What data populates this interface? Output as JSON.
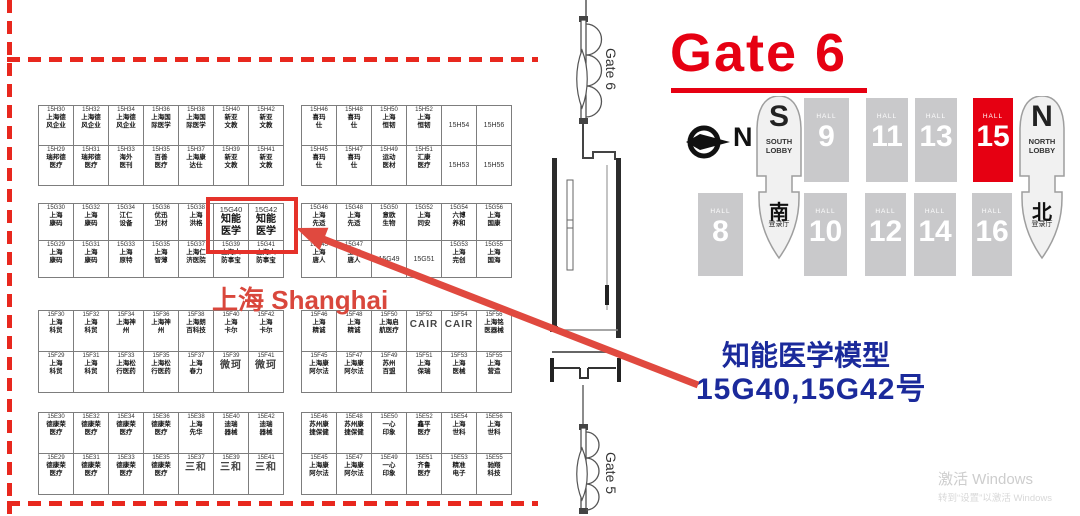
{
  "heading": {
    "gate6": "Gate 6"
  },
  "corridor": {
    "gate6_label": "Gate 6",
    "gate5_label": "Gate 5"
  },
  "compass": {
    "n": "N"
  },
  "hall_map": {
    "hall_label": "HALL",
    "halls_top": [
      {
        "num": "9"
      },
      {
        "num": "11"
      },
      {
        "num": "13"
      },
      {
        "num": "15",
        "highlight": true
      }
    ],
    "halls_bottom": [
      {
        "num": "8"
      },
      {
        "num": "10"
      },
      {
        "num": "12"
      },
      {
        "num": "14"
      },
      {
        "num": "16"
      }
    ],
    "south_lobby": {
      "letter": "S",
      "line1": "SOUTH",
      "line2": "LOBBY"
    },
    "north_lobby": {
      "letter": "N",
      "line1": "NORTH",
      "line2": "LOBBY"
    },
    "south_reg": {
      "cn": "南",
      "sub": "登录厅"
    },
    "north_reg": {
      "cn": "北",
      "sub": "登录厅"
    }
  },
  "annotation": {
    "line1": "知能医学模型",
    "line2": "15G40,15G42号",
    "shanghai": "上海 Shanghai"
  },
  "watermark": {
    "line1": "激活 Windows",
    "line2": "转到“设置”以激活 Windows"
  },
  "colors": {
    "accent_red": "#e60012",
    "arrow_red": "#e0493f",
    "annotation_blue": "#1b2a9b",
    "hall_gray": "#c9c9cb"
  },
  "booth_blocks": {
    "h_left": [
      [
        [
          "15H30",
          "上海德\n风企业"
        ],
        [
          "15H32",
          "上海德\n风企业"
        ],
        [
          "15H34",
          "上海德\n风企业"
        ],
        [
          "15H36",
          "上海国\n际医学"
        ],
        [
          "15H38",
          "上海国\n际医学"
        ],
        [
          "15H40",
          "新亚\n文教"
        ],
        [
          "15H42",
          "新亚\n文教"
        ]
      ],
      [
        [
          "15H29",
          "瑞邦德\n医疗"
        ],
        [
          "15H31",
          "瑞邦德\n医疗"
        ],
        [
          "15H33",
          "海外\n医刊"
        ],
        [
          "15H35",
          "百善\n医疗"
        ],
        [
          "15H37",
          "上海康\n达仕"
        ],
        [
          "15H39",
          "新亚\n文教"
        ],
        [
          "15H41",
          "新亚\n文教"
        ]
      ]
    ],
    "h_right": [
      [
        [
          "15H46",
          "喜玛\n仕"
        ],
        [
          "15H48",
          "喜玛\n仕"
        ],
        [
          "15H50",
          "上海\n恒韧"
        ],
        [
          "15H52",
          "上海\n恒韧"
        ],
        [
          "15H54",
          ""
        ],
        [
          "15H56",
          ""
        ]
      ],
      [
        [
          "15H45",
          "喜玛\n仕"
        ],
        [
          "15H47",
          "喜玛\n仕"
        ],
        [
          "15H49",
          "运动\n医材"
        ],
        [
          "15H51",
          "汇康\n医疗"
        ],
        [
          "15H53",
          ""
        ],
        [
          "15H55",
          ""
        ]
      ]
    ],
    "g_left": [
      [
        [
          "15G30",
          "上海\n康码"
        ],
        [
          "15G32",
          "上海\n康码"
        ],
        [
          "15G34",
          "江仁\n设备"
        ],
        [
          "15G36",
          "优迅\n卫材"
        ],
        [
          "15G38",
          "上海\n洪格"
        ],
        [
          "15G40",
          "知能\n医学",
          "hl"
        ],
        [
          "15G42",
          "知能\n医学",
          "hl"
        ]
      ],
      [
        [
          "15G29",
          "上海\n康码"
        ],
        [
          "15G31",
          "上海\n康码"
        ],
        [
          "15G33",
          "上海\n原特"
        ],
        [
          "15G35",
          "上海\n智薄"
        ],
        [
          "15G37",
          "上海仁\n济医院"
        ],
        [
          "15G39",
          "上海人\n防事宝"
        ],
        [
          "15G41",
          "上海人\n防事宝"
        ]
      ]
    ],
    "g_right": [
      [
        [
          "15G46",
          "上海\n先适"
        ],
        [
          "15G48",
          "上海\n先适"
        ],
        [
          "15G50",
          "意欧\n生物"
        ],
        [
          "15G52",
          "上海\n同安"
        ],
        [
          "15G54",
          "六博\n养和"
        ],
        [
          "15G56",
          "上海\n国康"
        ]
      ],
      [
        [
          "15G45",
          "上海\n唐人"
        ],
        [
          "15G47",
          "上海\n唐人"
        ],
        [
          "15G49",
          ""
        ],
        [
          "15G51",
          ""
        ],
        [
          "15G53",
          "上海\n完创"
        ],
        [
          "15G55",
          "上海\n国海"
        ]
      ]
    ],
    "f_left": [
      [
        [
          "15F30",
          "上海\n科贸"
        ],
        [
          "15F32",
          "上海\n科贸"
        ],
        [
          "15F34",
          "上海神\n州"
        ],
        [
          "15F36",
          "上海神\n州"
        ],
        [
          "15F38",
          "上海朗\n百科技"
        ],
        [
          "15F40",
          "上海\n卡尔"
        ],
        [
          "15F42",
          "上海\n卡尔"
        ]
      ],
      [
        [
          "15F29",
          "上海\n科贸"
        ],
        [
          "15F31",
          "上海\n科贸"
        ],
        [
          "15F33",
          "上海松\n行医药"
        ],
        [
          "15F35",
          "上海松\n行医药"
        ],
        [
          "15F37",
          "上海\n春力"
        ],
        [
          "15F39",
          "微珂",
          "big"
        ],
        [
          "15F41",
          "微珂",
          "big"
        ]
      ]
    ],
    "f_right": [
      [
        [
          "15F46",
          "上海\n精诚"
        ],
        [
          "15F48",
          "上海\n精诚"
        ],
        [
          "15F50",
          "上海启\n航医疗"
        ],
        [
          "15F52",
          "CAIR",
          "big"
        ],
        [
          "15F54",
          "CAIR",
          "big"
        ],
        [
          "15F56",
          "上海铭\n医器械"
        ]
      ],
      [
        [
          "15F45",
          "上海康\n阿尔法"
        ],
        [
          "15F47",
          "上海康\n阿尔法"
        ],
        [
          "15F49",
          "苏州\n百盟"
        ],
        [
          "15F51",
          "上海\n保瑞"
        ],
        [
          "15F53",
          "上海\n医械"
        ],
        [
          "15F55",
          "上海\n营造"
        ]
      ]
    ],
    "e_left": [
      [
        [
          "15E30",
          "德康荣\n医疗"
        ],
        [
          "15E32",
          "德康荣\n医疗"
        ],
        [
          "15E34",
          "德康荣\n医疗"
        ],
        [
          "15E36",
          "德康荣\n医疗"
        ],
        [
          "15E38",
          "上海\n先华"
        ],
        [
          "15E40",
          "迪瑞\n器械"
        ],
        [
          "15E42",
          "迪瑞\n器械"
        ]
      ],
      [
        [
          "15E29",
          "德康荣\n医疗"
        ],
        [
          "15E31",
          "德康荣\n医疗"
        ],
        [
          "15E33",
          "德康荣\n医疗"
        ],
        [
          "15E35",
          "德康荣\n医疗"
        ],
        [
          "15E37",
          "三和",
          "big"
        ],
        [
          "15E39",
          "三和",
          "big"
        ],
        [
          "15E41",
          "三和",
          "big"
        ]
      ]
    ],
    "e_right": [
      [
        [
          "15E46",
          "苏州康\n捷保健"
        ],
        [
          "15E48",
          "苏州康\n捷保健"
        ],
        [
          "15E50",
          "一心\n印象"
        ],
        [
          "15E52",
          "鑫平\n医疗"
        ],
        [
          "15E54",
          "上海\n世科"
        ],
        [
          "15E56",
          "上海\n世科"
        ]
      ],
      [
        [
          "15E45",
          "上海康\n阿尔法"
        ],
        [
          "15E47",
          "上海康\n阿尔法"
        ],
        [
          "15E49",
          "一心\n印象"
        ],
        [
          "15E51",
          "齐鲁\n医疗"
        ],
        [
          "15E53",
          "精准\n电子"
        ],
        [
          "15E55",
          "驰翔\n科技"
        ]
      ]
    ]
  }
}
